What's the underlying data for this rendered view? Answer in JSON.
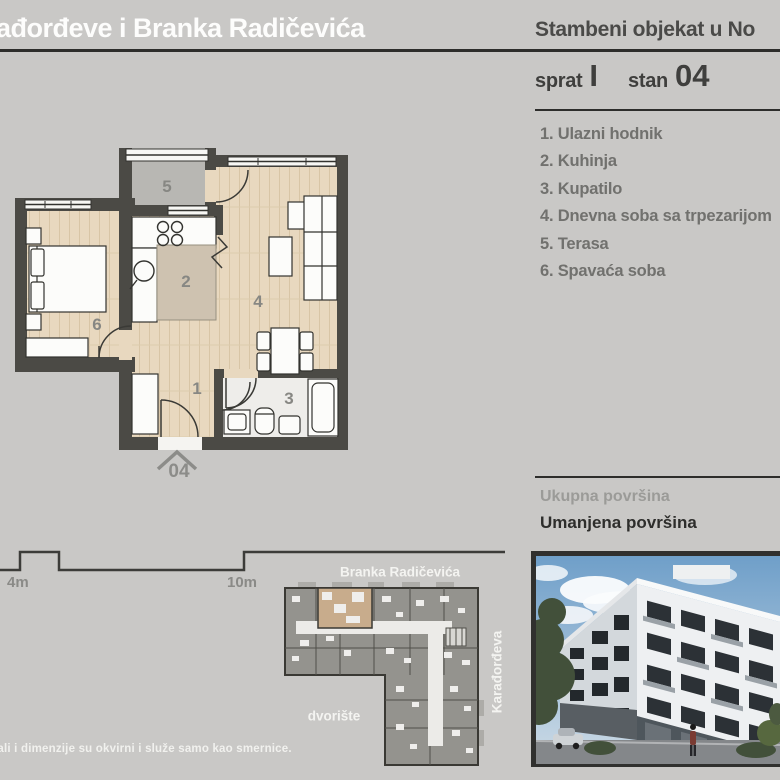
{
  "header": {
    "left_title": "ađorđeve i Branka Radičevića",
    "right_title": "Stambeni objekat u No"
  },
  "unit_info": {
    "floor_label": "sprat",
    "floor_value": "I",
    "apartment_label": "stan",
    "apartment_value": "04"
  },
  "room_list": [
    "1. Ulazni hodnik",
    "2. Kuhinja",
    "3. Kupatilo",
    "4. Dnevna soba sa trpezarijom",
    "5. Terasa",
    "6. Spavaća soba"
  ],
  "areas": {
    "total_label": "Ukupna površina",
    "reduced_label": "Umanjena površina"
  },
  "floor_plan": {
    "room_numbers": [
      "1",
      "2",
      "3",
      "4",
      "5",
      "6"
    ],
    "entrance_label": "04"
  },
  "scale_bar": {
    "first_label": "4m",
    "second_label": "10m"
  },
  "site_plan": {
    "street_top": "Branka Radičevića",
    "street_right": "Karađorđeva",
    "courtyard_label": "dvorište"
  },
  "disclaimer": "jali i dimenzije su okvirni i služe samo kao smernice.",
  "colors": {
    "background": "#c9c8c6",
    "wall": "#4b4a45",
    "wood_floor": "#e8d8bf",
    "terrace_floor": "#b8b7b3",
    "highlight_unit": "#c8ac8c",
    "text_dark": "#3f3f3d",
    "text_muted": "#8a8a87",
    "sky": "#6f9fc9"
  }
}
